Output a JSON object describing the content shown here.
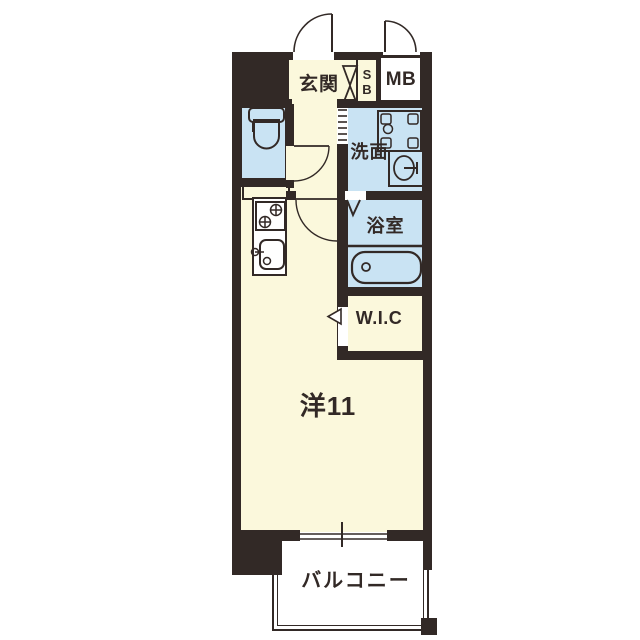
{
  "floorplan": {
    "rooms": {
      "genkan": "玄関",
      "shoe_box": "SB",
      "meter_box": "MB",
      "washroom": "洗面",
      "bathroom": "浴室",
      "walk_in_closet": "W.I.C",
      "western_room": "洋11",
      "balcony": "バルコニー"
    },
    "colors": {
      "wall": "#322926",
      "floor_cream": "#FBF8DC",
      "wet_area_blue": "#C9E3F3",
      "background": "#FFFFFF"
    },
    "icons": [
      "entrance-door-swing",
      "meter-box-door-swing",
      "shoe-box-doors",
      "toilet",
      "toilet-door-swing",
      "accordion-door",
      "washing-machine-pan",
      "vanity-sink",
      "room-door-swing",
      "bathroom-folding-door",
      "bathtub",
      "stove",
      "kitchen-sink",
      "wic-sliding-door",
      "window",
      "balcony-rail"
    ]
  }
}
